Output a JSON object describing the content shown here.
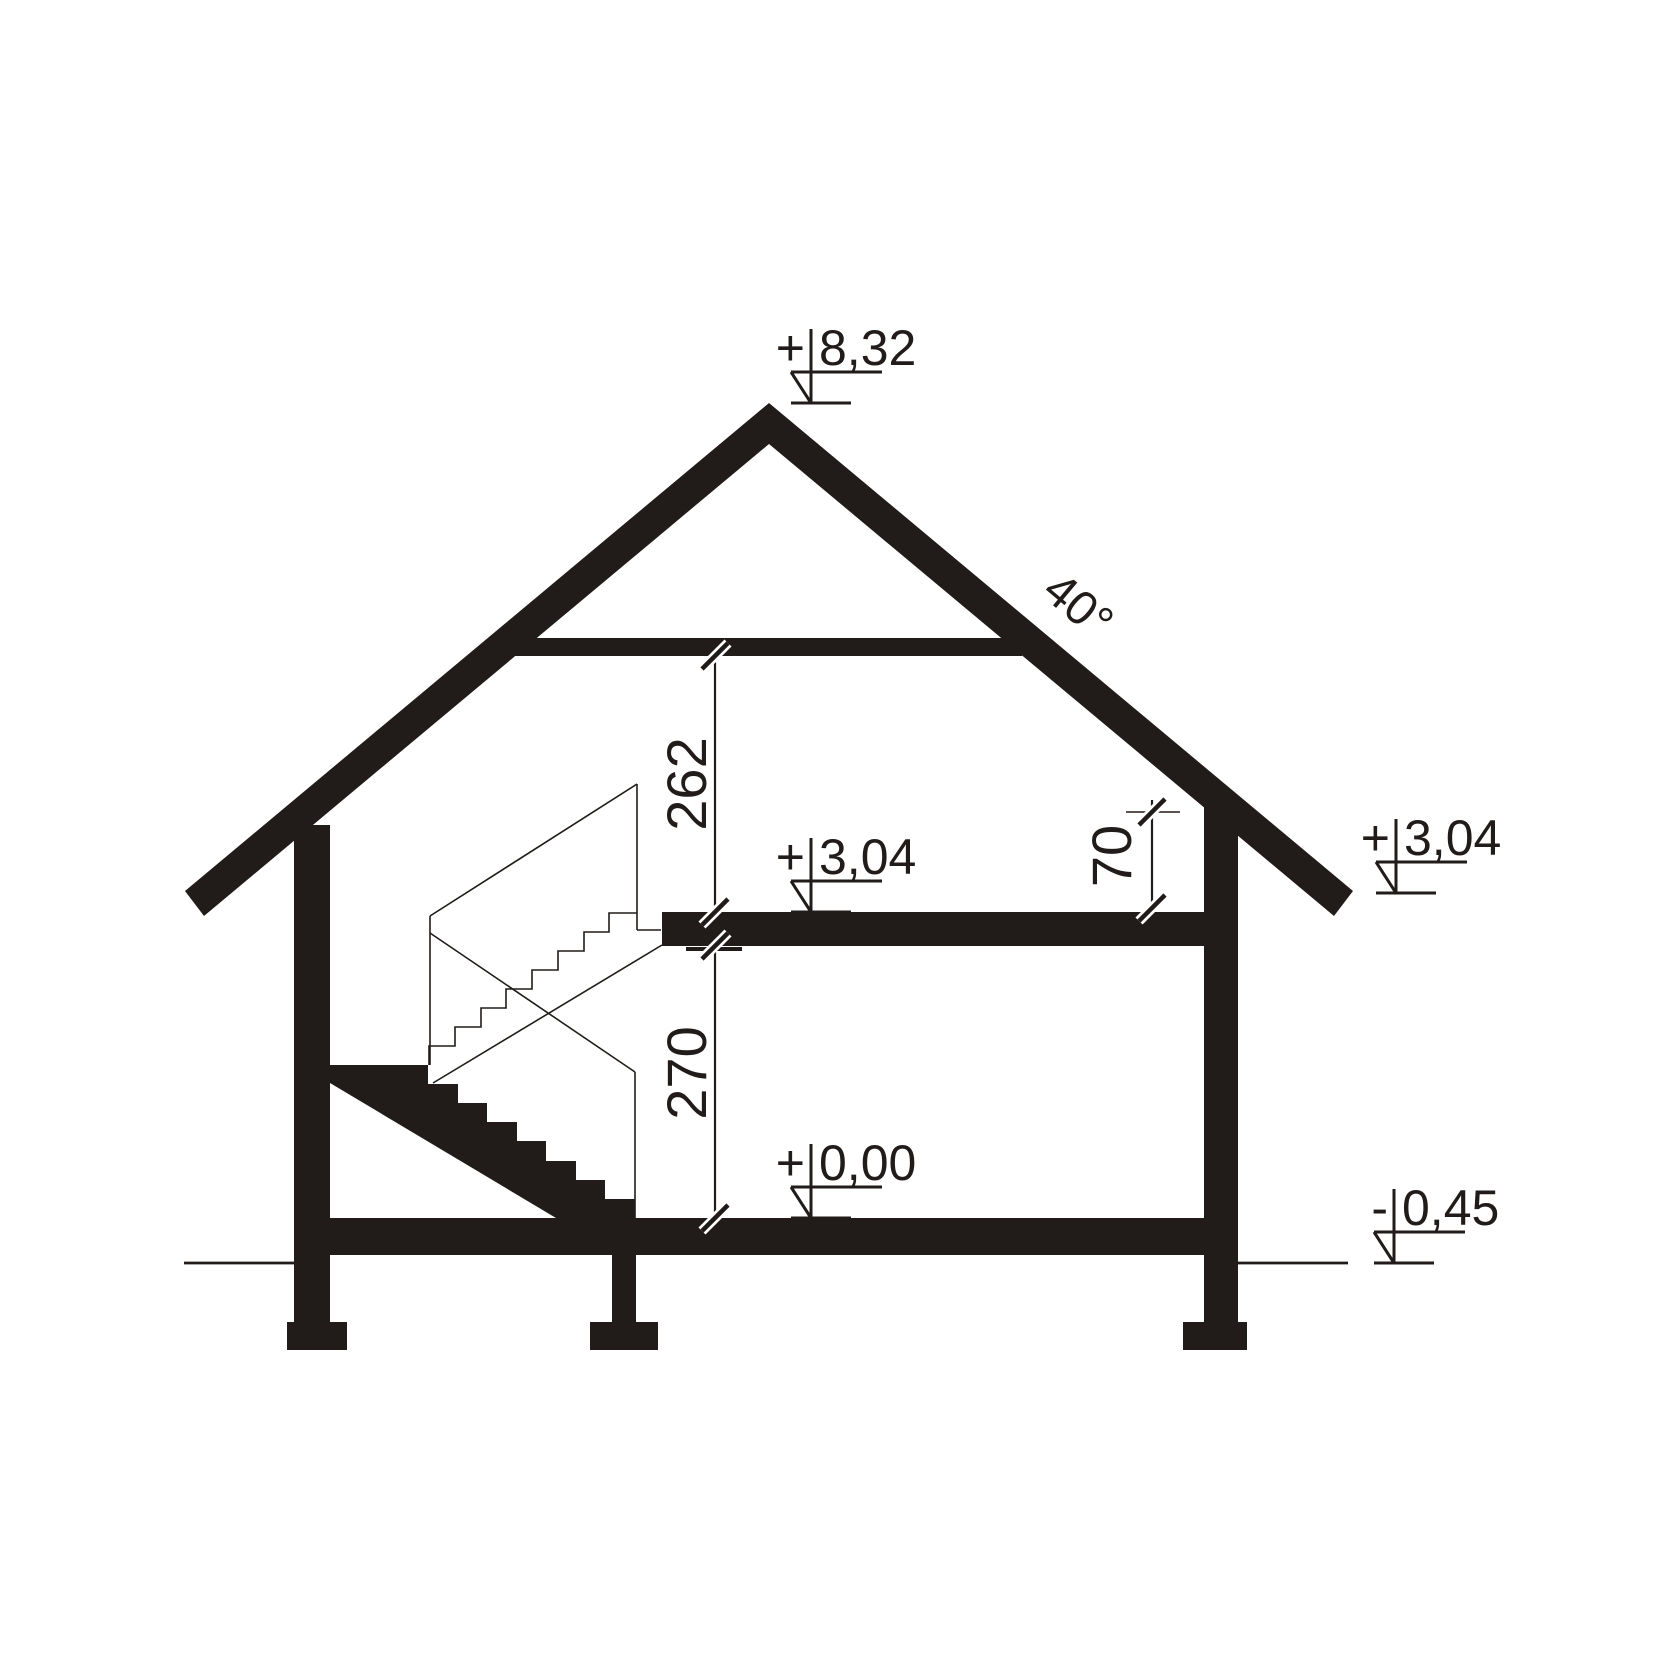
{
  "drawing": {
    "kind": "house-cross-section",
    "background_color": "#ffffff",
    "ink_color": "#211c19",
    "roof_angle_label": "40°",
    "levels": {
      "ridge": {
        "sign": "+",
        "value": "8,32"
      },
      "upper_floor": {
        "sign": "+",
        "value": "3,04"
      },
      "right_eave": {
        "sign": "+",
        "value": "3,04"
      },
      "ground_floor": {
        "sign": "+",
        "value": "0,00"
      },
      "terrain": {
        "sign": "-",
        "value": "0,45"
      }
    },
    "dimensions": {
      "attic_room_height": "262",
      "ground_room_height": "270",
      "knee_wall_height": "70"
    }
  }
}
